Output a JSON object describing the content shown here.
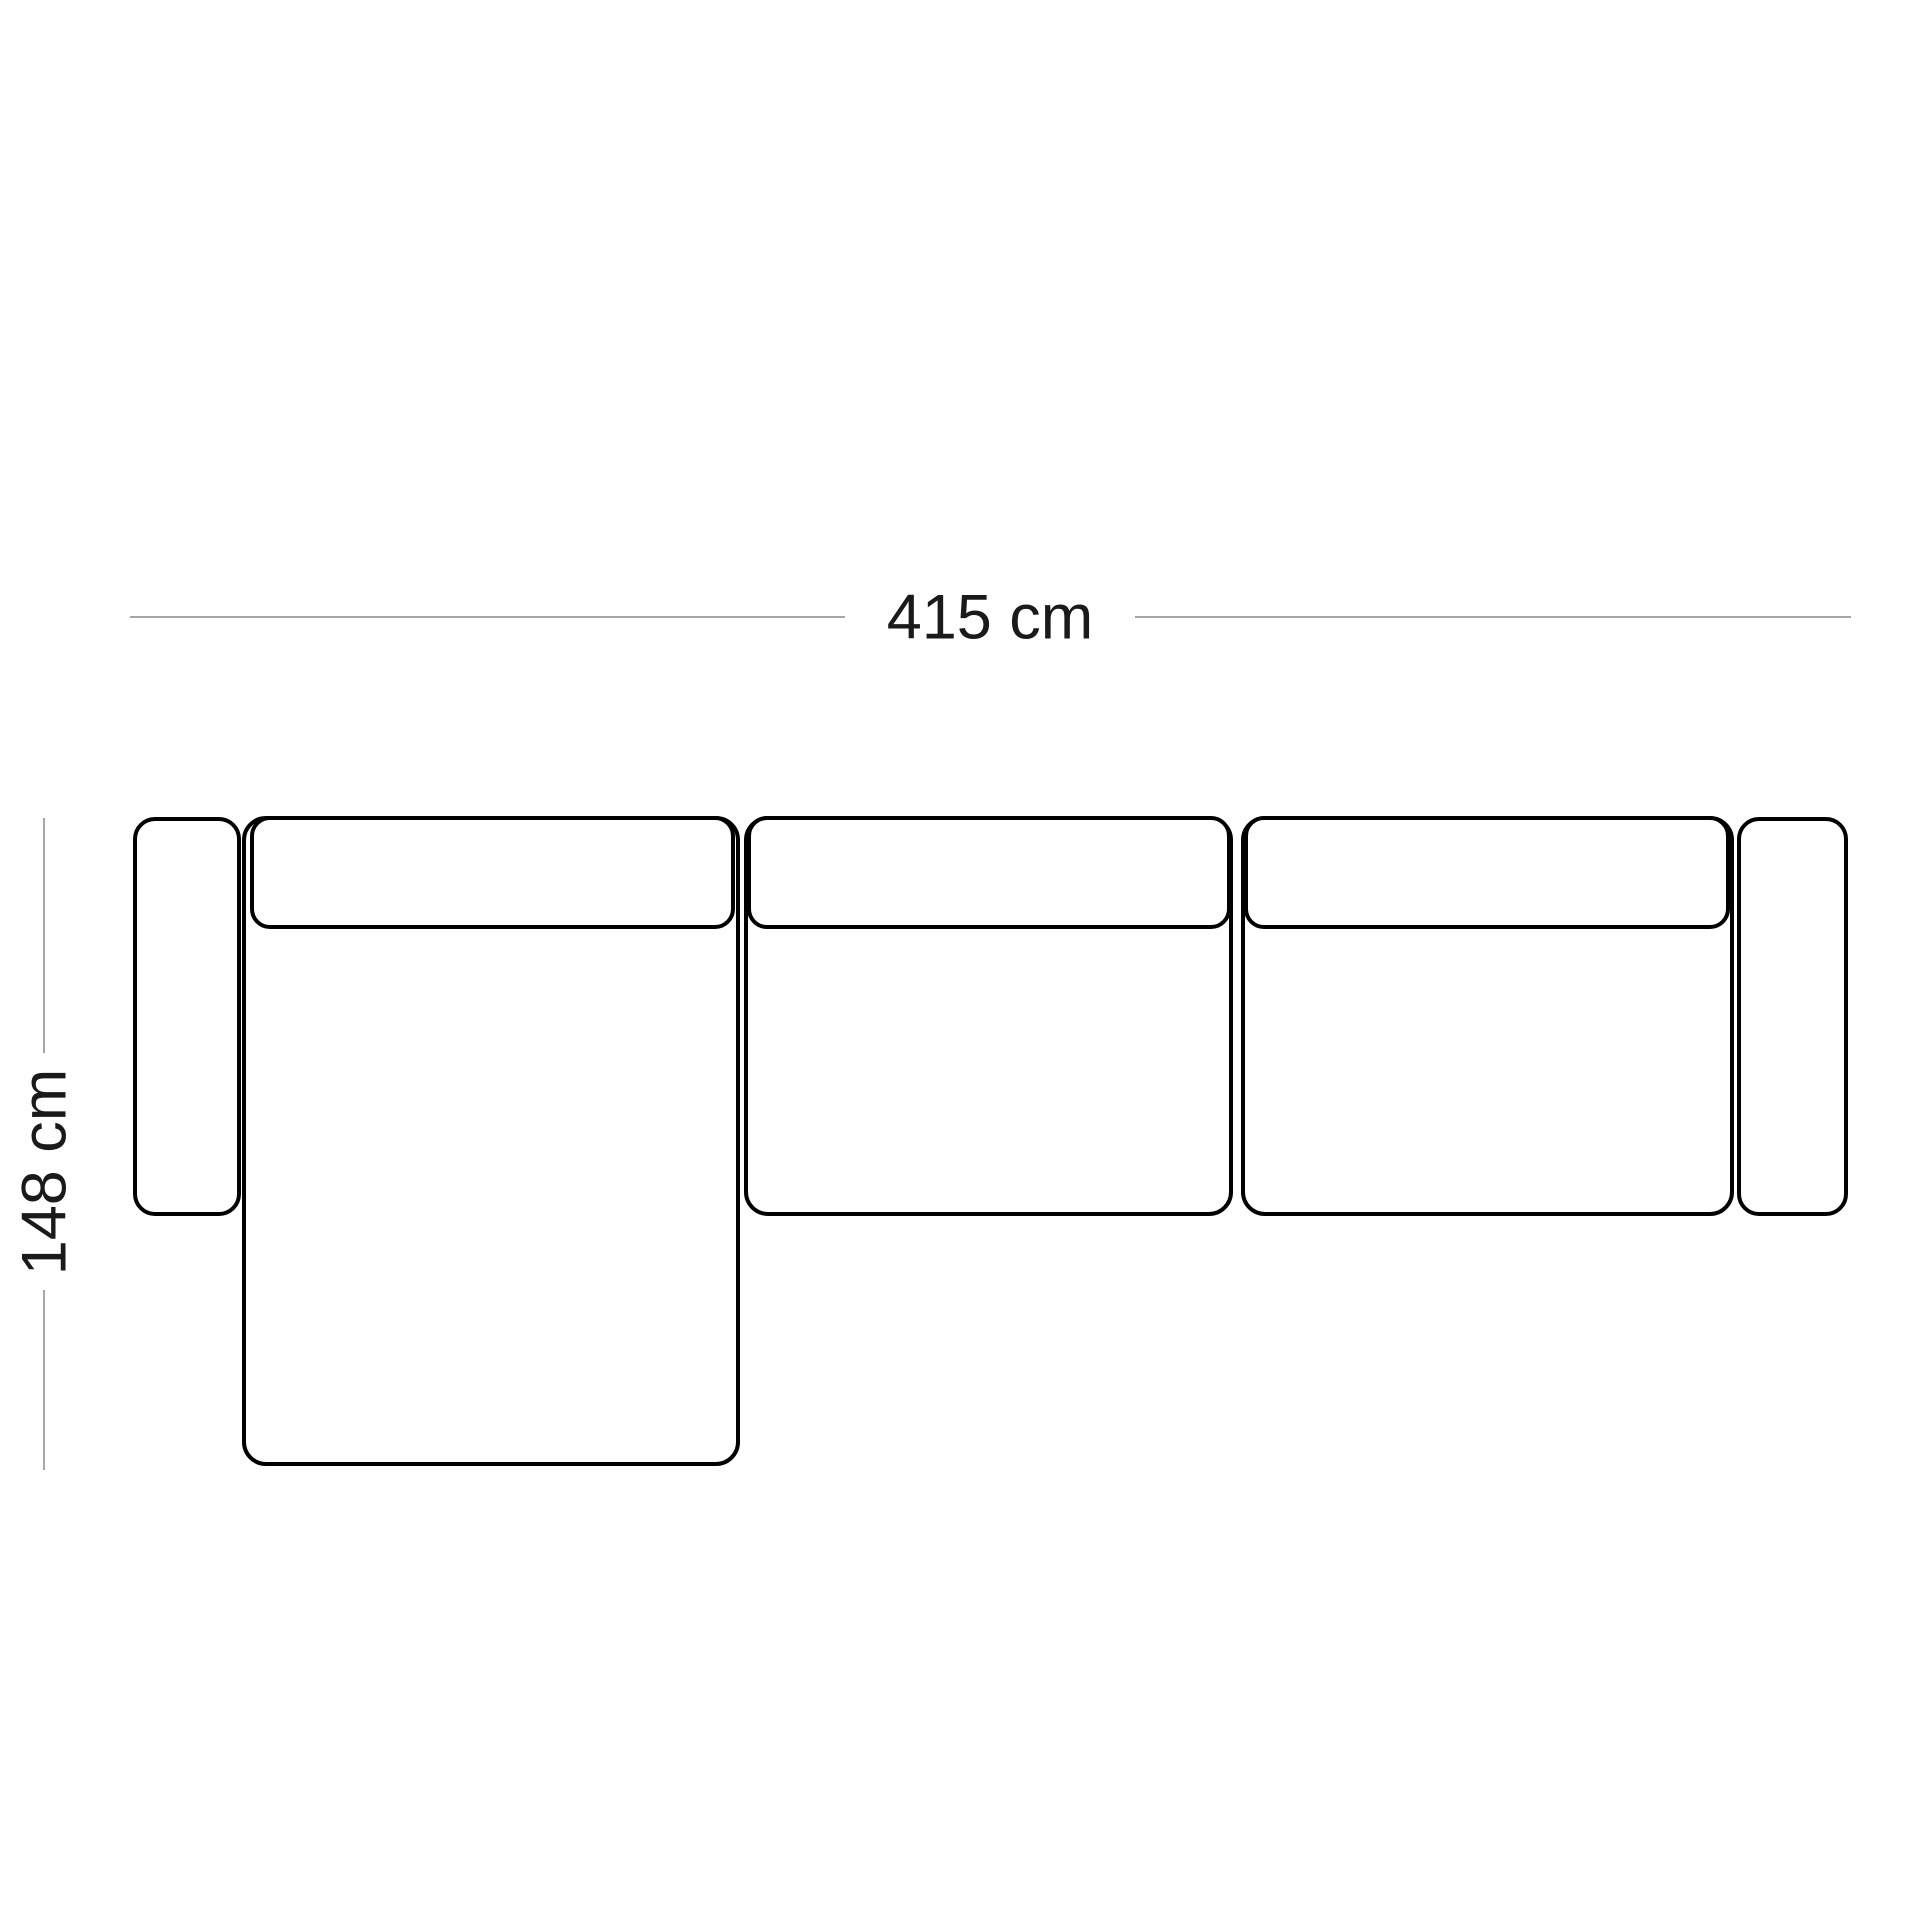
{
  "diagram": {
    "kind": "sofa-top-view-dimension-schematic",
    "units": "cm",
    "width_cm": 415,
    "depth_cm": 148
  },
  "dimensions": {
    "width": {
      "label": "415 cm"
    },
    "depth": {
      "label": "148 cm"
    }
  },
  "colors": {
    "outline": "#000000",
    "dimension_line": "#a6a6a6",
    "label_text": "#1a1a1a",
    "background": "#ffffff"
  },
  "parts": [
    {
      "name": "left-armrest"
    },
    {
      "name": "chaise-seat-module"
    },
    {
      "name": "chaise-backrest-cushion"
    },
    {
      "name": "middle-seat-module"
    },
    {
      "name": "middle-backrest-cushion"
    },
    {
      "name": "right-seat-module"
    },
    {
      "name": "right-backrest-cushion"
    },
    {
      "name": "right-armrest"
    }
  ]
}
